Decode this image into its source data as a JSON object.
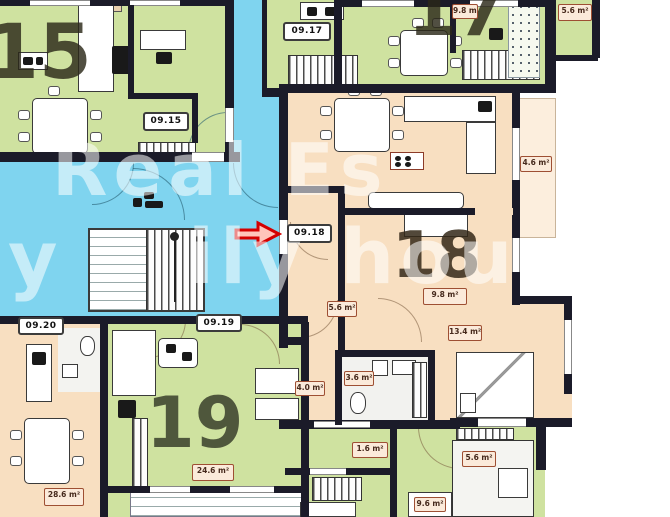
{
  "title": "apartment-floor-plan",
  "colors": {
    "apartment_green": "#cfe2a0",
    "corridor_blue": "#7fd4ef",
    "apartment_orange": "#f8dfc1",
    "balcony_peach": "#fceedd",
    "wall_dark": "#1b1b29",
    "arrow_red": "#d40000",
    "area_label_border": "#9e4f33"
  },
  "unit_numbers": {
    "apt15": "15",
    "apt17": "17",
    "apt18": "18",
    "apt19": "19"
  },
  "door_labels": {
    "apt15": "09.15",
    "apt17": "09.17",
    "apt18": "09.18",
    "apt19": "09.19",
    "apt20": "09.20"
  },
  "area_labels": [
    {
      "text": "9.8 m²"
    },
    {
      "text": "5.6 m²"
    },
    {
      "text": "9.8 m²"
    },
    {
      "text": "5.6 m²"
    },
    {
      "text": "13.4 m²"
    },
    {
      "text": "4.0 m²"
    },
    {
      "text": "3.6 m²"
    },
    {
      "text": "4.6 m²"
    },
    {
      "text": "24.6 m²"
    },
    {
      "text": "28.6 m²"
    },
    {
      "text": "1.6 m²"
    },
    {
      "text": "5.6 m²"
    },
    {
      "text": "9.6 m²"
    }
  ],
  "watermark": {
    "line1": "Real Es",
    "line2a": "y",
    "line2b": "ily hou",
    "line3": "t"
  }
}
